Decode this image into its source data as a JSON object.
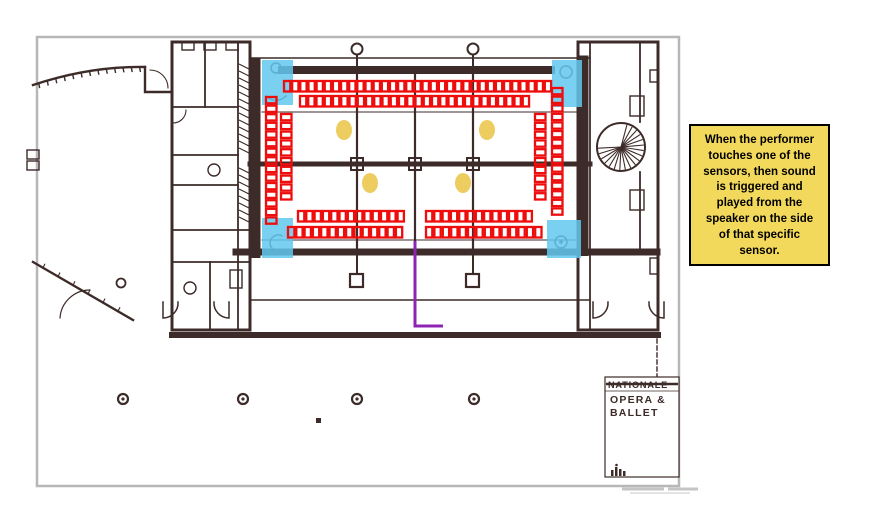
{
  "annotation_note": {
    "lines": [
      "When the performer",
      "touches one of the",
      "sensors, then sound",
      "is triggered and",
      "played from the",
      "speaker on the side",
      "of that specific",
      "sensor."
    ],
    "bg_color": "#f3d95b",
    "border_color": "#000000",
    "text_color": "#000000"
  },
  "title_block": {
    "name_line": "NATIONALE",
    "line2": "OPERA &",
    "line3": "BALLET"
  },
  "colors": {
    "plan_ink": "#3c2b28",
    "sheet_frame": "#b7b7b7",
    "sensor_red": "#ee0d0d",
    "speaker_cyan": "#62c8ee",
    "marker_yellow": "#edcd5f",
    "cable_purple": "#8e24b4"
  },
  "overlay": {
    "speakers": [
      {
        "id": "speaker-top-left",
        "x": 262,
        "y": 60,
        "w": 31,
        "h": 45
      },
      {
        "id": "speaker-top-right",
        "x": 552,
        "y": 60,
        "w": 30,
        "h": 47
      },
      {
        "id": "speaker-bottom-left",
        "x": 262,
        "y": 218,
        "w": 31,
        "h": 40
      },
      {
        "id": "speaker-bottom-right",
        "x": 547,
        "y": 220,
        "w": 34,
        "h": 38
      }
    ],
    "markers": [
      {
        "cx": 344,
        "cy": 130
      },
      {
        "cx": 487,
        "cy": 130
      },
      {
        "cx": 370,
        "cy": 183
      },
      {
        "cx": 463,
        "cy": 183
      }
    ],
    "sensor_strips": [
      {
        "orient": "h",
        "x": 284,
        "y": 81,
        "count": 33,
        "pitch": 8.15
      },
      {
        "orient": "h",
        "x": 300,
        "y": 96,
        "count": 28,
        "pitch": 8.25
      },
      {
        "orient": "h",
        "x": 298,
        "y": 211,
        "count": 13,
        "pitch": 8.3
      },
      {
        "orient": "h",
        "x": 426,
        "y": 211,
        "count": 13,
        "pitch": 8.3
      },
      {
        "orient": "h",
        "x": 288,
        "y": 227,
        "count": 14,
        "pitch": 8.3
      },
      {
        "orient": "h",
        "x": 426,
        "y": 227,
        "count": 14,
        "pitch": 8.4
      },
      {
        "orient": "v",
        "x": 266,
        "y": 97,
        "count": 15,
        "pitch": 8.6
      },
      {
        "orient": "v",
        "x": 281,
        "y": 114,
        "count": 10,
        "pitch": 8.8
      },
      {
        "orient": "v",
        "x": 535,
        "y": 114,
        "count": 10,
        "pitch": 8.8
      },
      {
        "orient": "v",
        "x": 552,
        "y": 88,
        "count": 15,
        "pitch": 8.6
      }
    ],
    "cable_points": "415,241 415,326 443,326"
  }
}
